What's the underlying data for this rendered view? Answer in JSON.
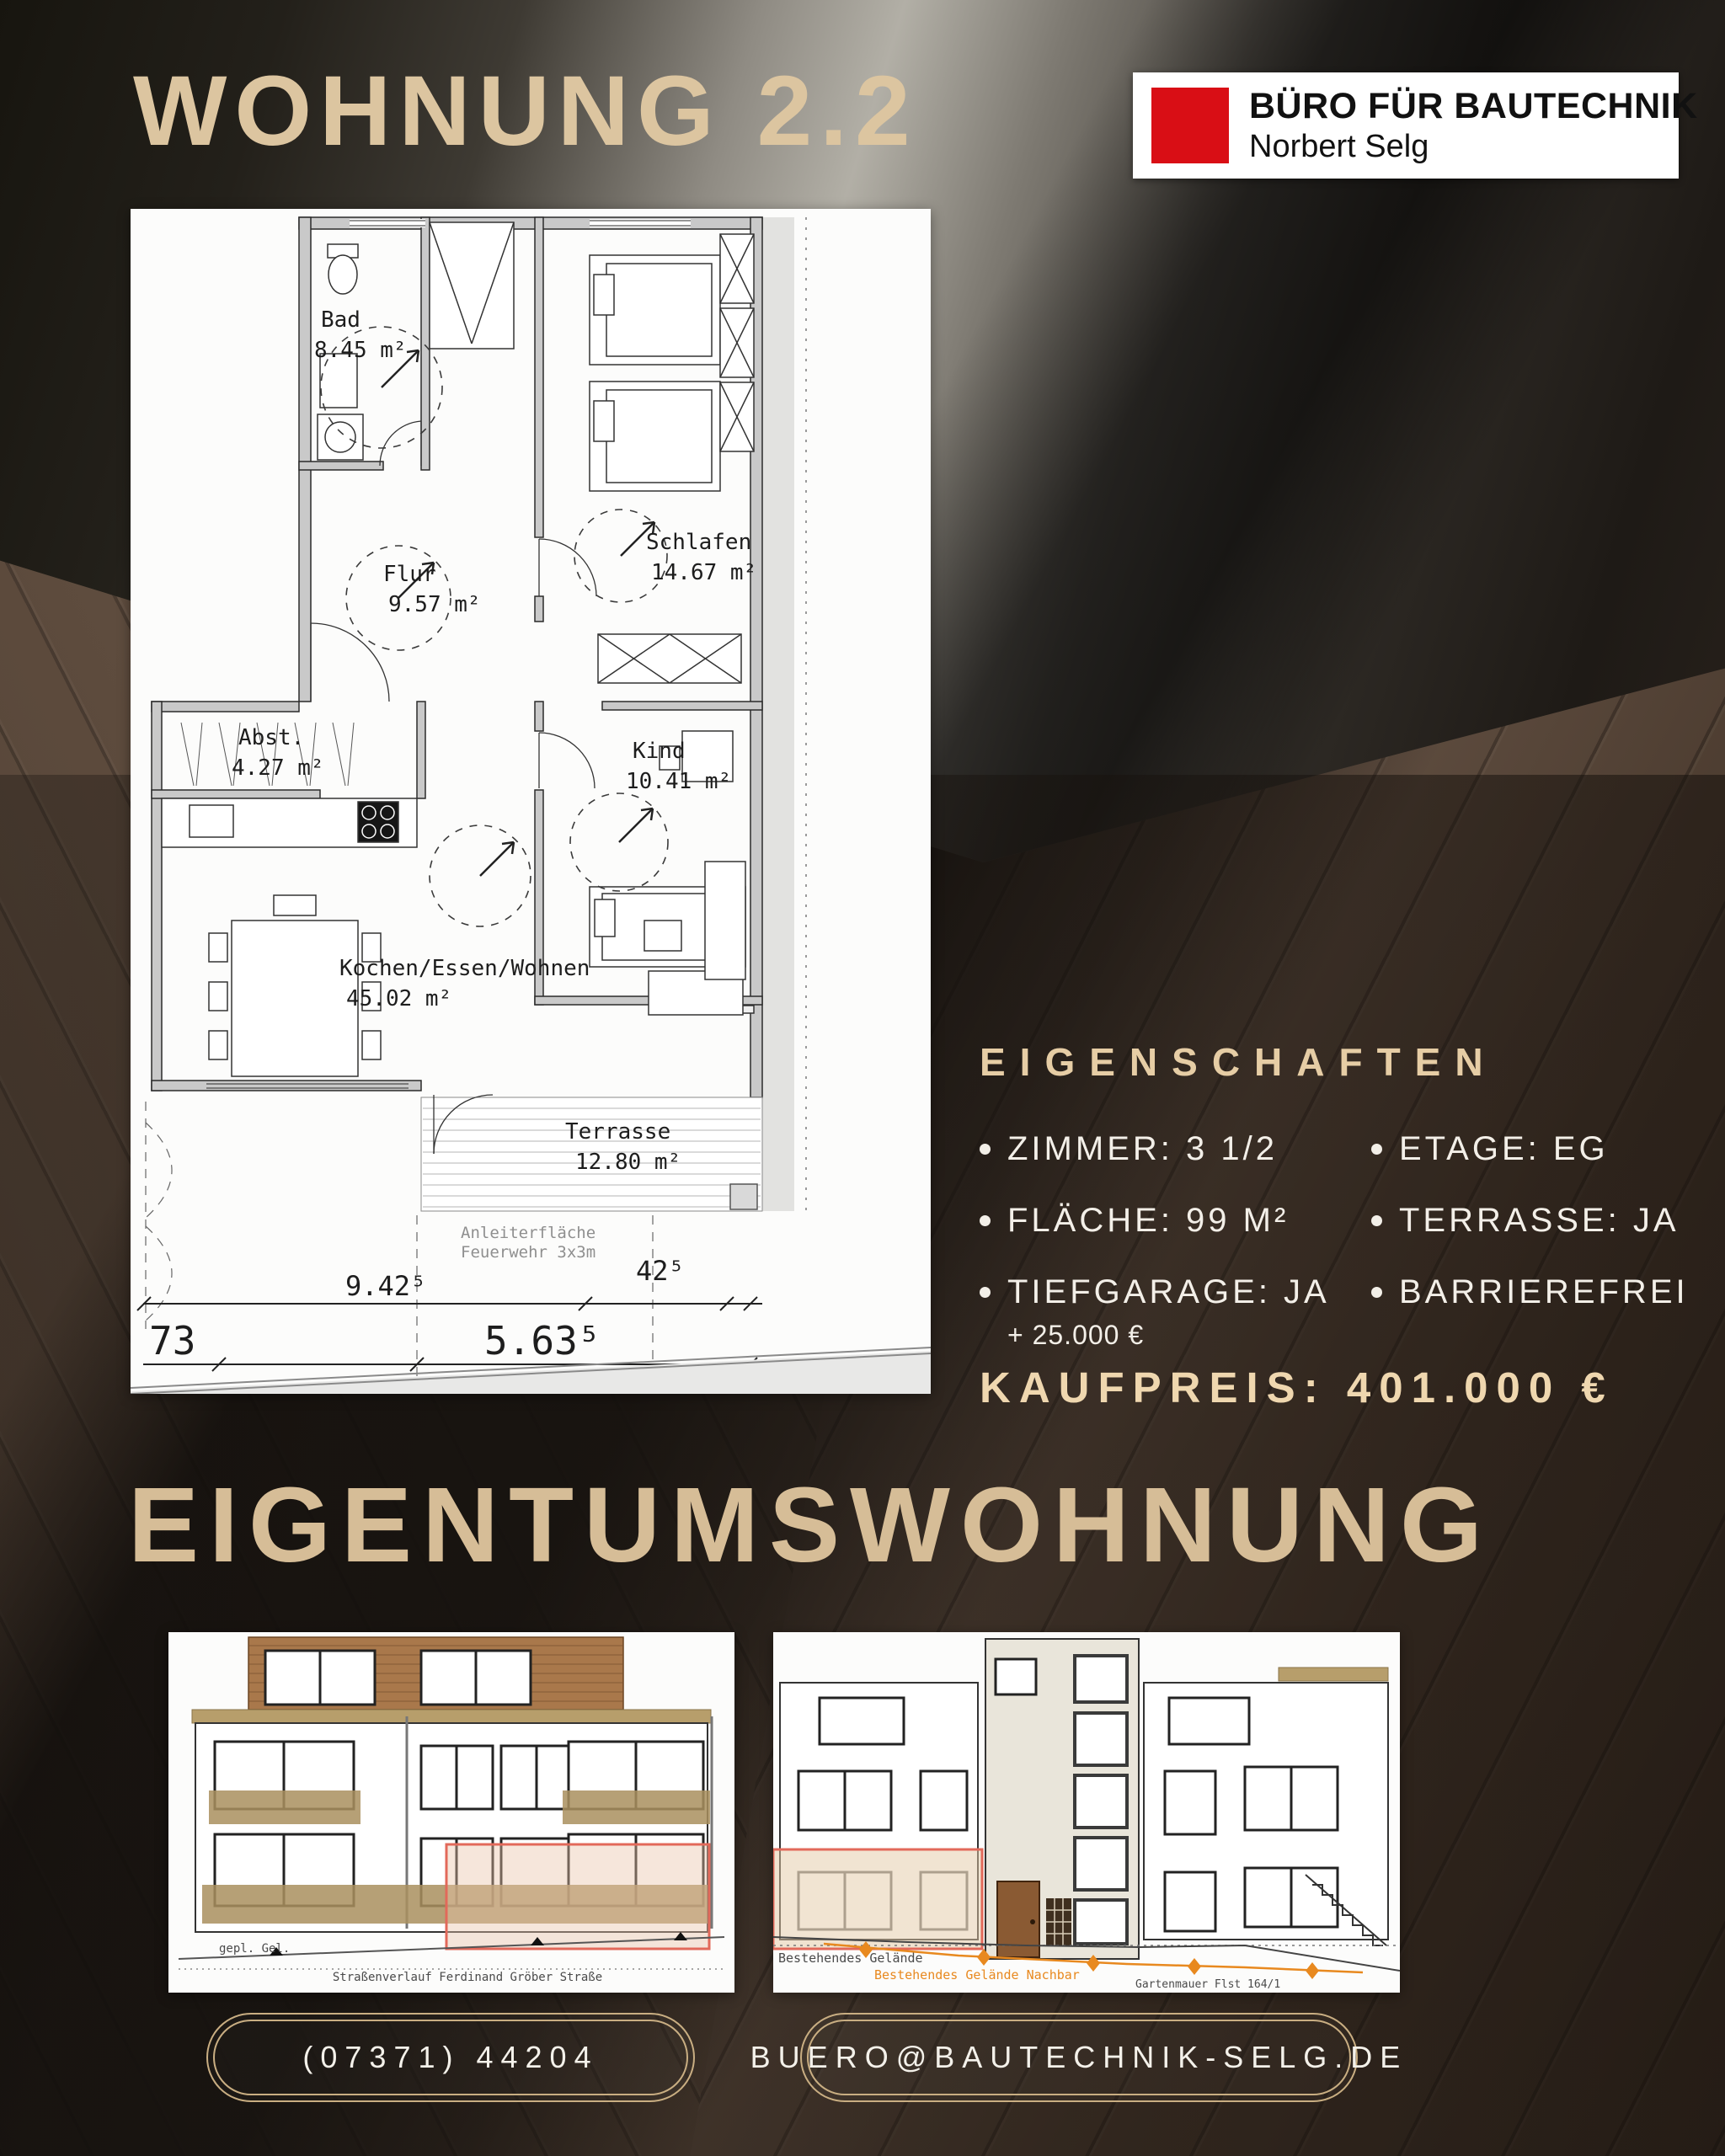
{
  "header": {
    "title": "WOHNUNG 2.2"
  },
  "logo": {
    "company": "BÜRO FÜR BAUTECHNIK",
    "person": "Norbert Selg"
  },
  "floorplan": {
    "rooms": [
      {
        "name": "Bad",
        "area": "8.45 m²"
      },
      {
        "name": "Schlafen",
        "area": "14.67 m²"
      },
      {
        "name": "Flur",
        "area": "9.57 m²"
      },
      {
        "name": "Kind",
        "area": "10.41 m²"
      },
      {
        "name": "Abst.",
        "area": "4.27 m²"
      },
      {
        "name": "Kochen/Essen/Wohnen",
        "area": "45.02 m²"
      },
      {
        "name": "Terrasse",
        "area": "12.80 m²"
      }
    ],
    "fire_note": [
      "Anleiterfläche",
      "Feuerwehr 3x3m"
    ],
    "dimensions": {
      "width_main": "9.42⁵",
      "width_right": "42⁵",
      "width_lower": "5.63⁵",
      "left_partial": "73"
    }
  },
  "properties": {
    "heading": "EIGENSCHAFTEN",
    "items": [
      {
        "label": "ZIMMER: 3 1/2"
      },
      {
        "label": "ETAGE: EG"
      },
      {
        "label": "FLÄCHE: 99 M²"
      },
      {
        "label": "TERRASSE: JA"
      },
      {
        "label": "TIEFGARAGE: JA",
        "note": "+ 25.000 €"
      },
      {
        "label": "BARRIEREFREI"
      }
    ],
    "price": "KAUFPREIS: 401.000 €"
  },
  "section_title": "EIGENTUMSWOHNUNG",
  "elevations": {
    "street": {
      "ground_label": "gepl. Gel.",
      "street_label": "Straßenverlauf Ferdinand Gröber Straße"
    },
    "garden": {
      "ground_label": "Bestehendes Gelände",
      "neighbor_label": "Bestehendes Gelände Nachbar",
      "wall_label": "Gartenmauer Flst 164/1"
    }
  },
  "contact": {
    "phone": "(07371) 44204",
    "email": "BUERO@BAUTECHNIK-SELG.DE"
  },
  "colors": {
    "accent_tan": "#dcc5a0",
    "logo_red": "#d90e15",
    "highlight_red": "#e2695a"
  }
}
